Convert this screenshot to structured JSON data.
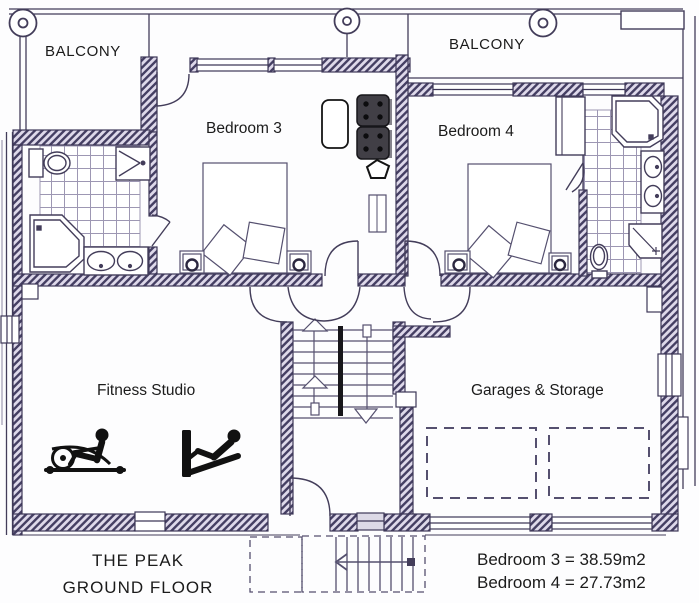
{
  "title": {
    "name": "THE PEAK",
    "floor": "GROUND FLOOR"
  },
  "rooms": {
    "balcony_left": "BALCONY",
    "balcony_right": "BALCONY",
    "bedroom3": "Bedroom 3",
    "bedroom4": "Bedroom 4",
    "fitness": "Fitness Studio",
    "garage": "Garages & Storage"
  },
  "areas": {
    "bedroom3": "Bedroom 3 = 38.59m2",
    "bedroom4": "Bedroom 4 = 27.73m2"
  },
  "colors": {
    "ink": "#433d5a",
    "wall_hatch": "#453f63",
    "tile_line": "#9d97b3",
    "text": "#1b1b1b",
    "furniture_dark": "#413f46",
    "icon_black": "#111111",
    "paper": "#ffffff"
  },
  "icons": {
    "columns": "column-icon",
    "toilet": "toilet-icon",
    "shower": "shower-icon",
    "corner_bath": "corner-bath-icon",
    "sink": "sink-icon",
    "bed": "bed-icon",
    "pillow": "pillow-icon",
    "lamp": "bedside-lamp-icon",
    "stairs": "stairs-icon",
    "door": "door-arc-icon",
    "rowing_machine": "rowing-machine-icon",
    "incline_bench": "incline-bench-icon",
    "armchairs": "armchair-icon",
    "rug": "rug-icon",
    "stool": "pentagon-stool-icon",
    "parking_bay": "parking-bay-icon"
  }
}
